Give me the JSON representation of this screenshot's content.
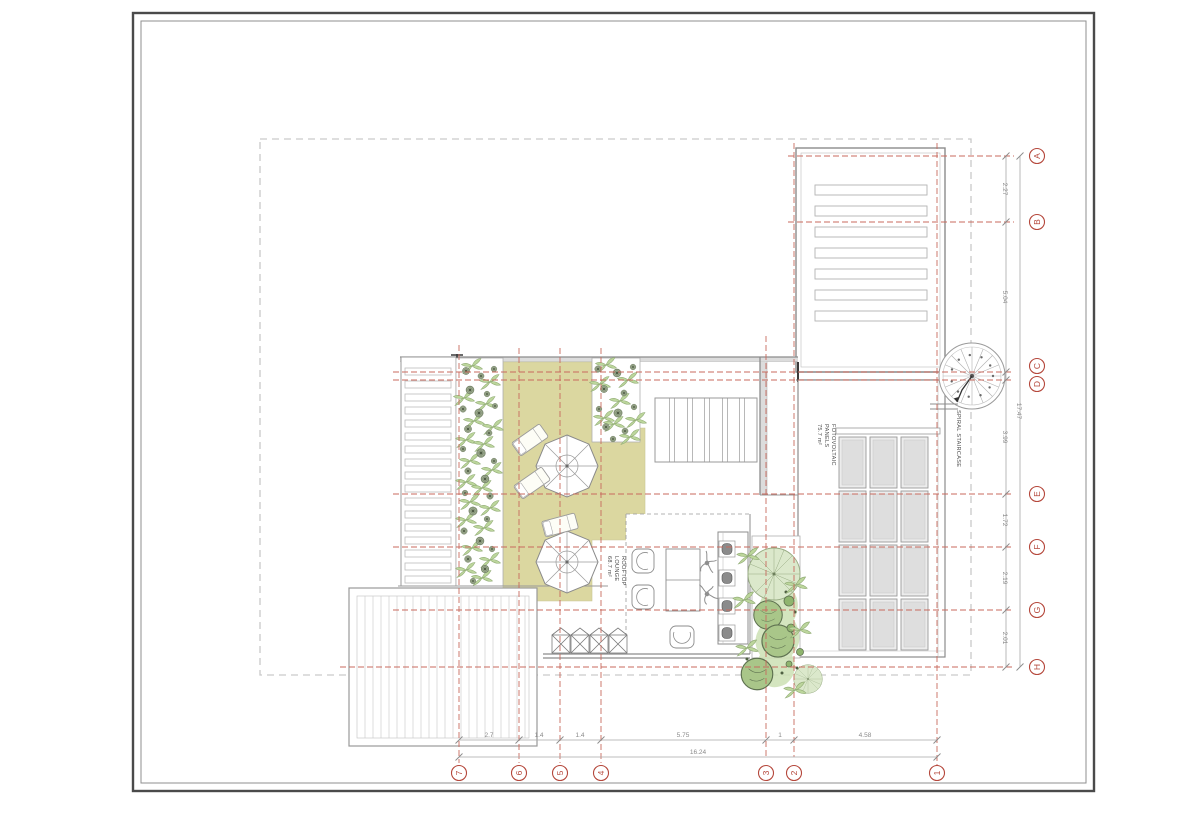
{
  "sheet": {
    "background": "#ffffff"
  },
  "axes": {
    "horizontal": [
      {
        "label": "A"
      },
      {
        "label": "B"
      },
      {
        "label": "C"
      },
      {
        "label": "D"
      },
      {
        "label": "E"
      },
      {
        "label": "F"
      },
      {
        "label": "G"
      },
      {
        "label": "H"
      }
    ],
    "vertical": [
      {
        "label": "7"
      },
      {
        "label": "6"
      },
      {
        "label": "5"
      },
      {
        "label": "4"
      },
      {
        "label": "3"
      },
      {
        "label": "2"
      },
      {
        "label": "1"
      }
    ]
  },
  "dimensions": {
    "right": {
      "segments": [
        "2.27",
        "5.04",
        "3.99",
        "1.72",
        "2.19",
        "2.01"
      ],
      "total": "17.47"
    },
    "bottom": {
      "segments": [
        "2.7",
        "1.4",
        "1.4",
        "5.75",
        "1",
        "4.58"
      ],
      "total": "16.24"
    }
  },
  "labels": {
    "spiral_staircase": "SPIRAL STAIRCASE",
    "pv": {
      "line1": "FOTOVOLTAIC",
      "line2": "PANELS",
      "area": "75.7 m²"
    },
    "lounge": {
      "line1": "ROOFTOP",
      "line2": "LOUNGE",
      "area": "68.7 m²"
    }
  },
  "colors": {
    "accent_red": "#b5483c",
    "grid_red": "#c86a5e",
    "tan_deck": "#dbd7a0",
    "green_light": "#dbe8cb",
    "green_mid": "#a9c689",
    "green_dark": "#5e7150",
    "wall_gray": "#8c8c8c",
    "boundary_gray": "#c9c9c9"
  }
}
